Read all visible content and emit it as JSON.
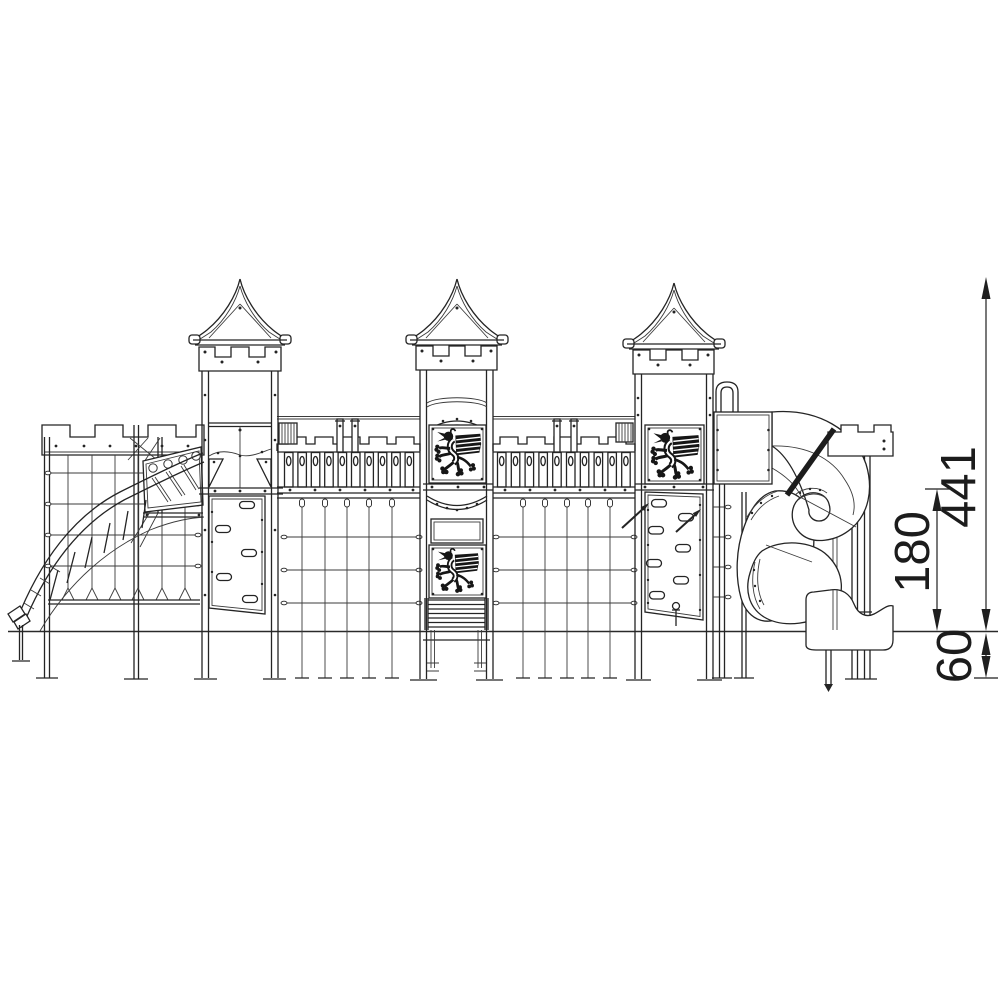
{
  "drawing": {
    "dimensions": {
      "total_height": "441",
      "platform_height": "180",
      "foundation_depth": "60"
    },
    "palette": {
      "background": "#ffffff",
      "line": "#242424",
      "dimension_text": "#1c1c1c"
    }
  }
}
